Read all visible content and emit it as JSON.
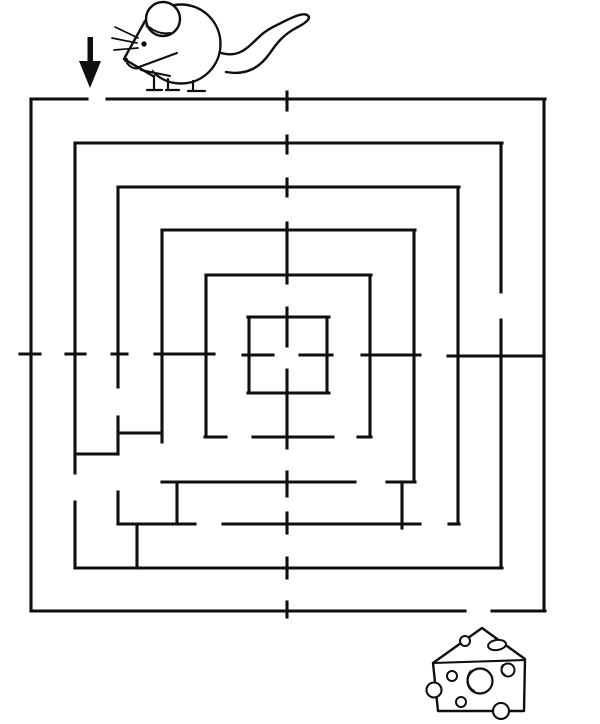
{
  "meta": {
    "kind": "printable-maze-puzzle",
    "description": "Square concentric maze; mouse with down-arrow marks the entrance at top, cheese wedge marks the goal at bottom right"
  },
  "colors": {
    "background": "#ffffff",
    "ink": "#0f0f0f"
  },
  "markers": {
    "start_icon": "mouse-icon",
    "start_pointer_icon": "down-arrow-icon",
    "goal_icon": "cheese-icon"
  },
  "maze": {
    "width": 600,
    "height": 724,
    "stroke_width": 3.1,
    "entrance_gap_x": [
      87,
      107
    ],
    "exit_gap_x": [
      465,
      492
    ],
    "h_walls": [
      [
        99,
        31,
        87
      ],
      [
        99,
        107,
        545
      ],
      [
        143,
        75,
        502
      ],
      [
        187,
        118,
        459
      ],
      [
        230,
        162,
        415
      ],
      [
        275,
        206,
        371
      ],
      [
        317,
        248,
        329
      ],
      [
        393,
        248,
        329
      ],
      [
        437,
        205,
        226
      ],
      [
        437,
        253,
        333
      ],
      [
        437,
        358,
        371
      ],
      [
        482,
        162,
        355
      ],
      [
        482,
        387,
        415
      ],
      [
        524,
        118,
        195
      ],
      [
        524,
        223,
        420
      ],
      [
        524,
        449,
        459
      ],
      [
        568,
        75,
        502
      ],
      [
        611,
        31,
        465
      ],
      [
        611,
        492,
        545
      ],
      [
        433,
        118,
        162
      ],
      [
        454,
        75,
        118
      ],
      [
        354,
        20,
        40
      ],
      [
        354,
        66,
        85
      ],
      [
        354,
        112,
        127
      ],
      [
        354,
        155,
        214
      ],
      [
        355,
        243,
        273
      ],
      [
        355,
        300,
        332
      ],
      [
        355,
        362,
        420
      ],
      [
        356,
        448,
        544
      ]
    ],
    "v_walls": [
      [
        31,
        99,
        611
      ],
      [
        544,
        99,
        611
      ],
      [
        75,
        143,
        473
      ],
      [
        75,
        502,
        568
      ],
      [
        501,
        143,
        292
      ],
      [
        501,
        320,
        568
      ],
      [
        118,
        187,
        387
      ],
      [
        118,
        417,
        454
      ],
      [
        118,
        492,
        524
      ],
      [
        458,
        187,
        524
      ],
      [
        162,
        230,
        442
      ],
      [
        414,
        230,
        482
      ],
      [
        206,
        275,
        437
      ],
      [
        370,
        275,
        437
      ],
      [
        249,
        317,
        393
      ],
      [
        327,
        317,
        393
      ],
      [
        287,
        92,
        110
      ],
      [
        287,
        136,
        153
      ],
      [
        287,
        179,
        196
      ],
      [
        287,
        223,
        283
      ],
      [
        287,
        308,
        346
      ],
      [
        287,
        370,
        448
      ],
      [
        287,
        472,
        496
      ],
      [
        287,
        513,
        533
      ],
      [
        287,
        558,
        578
      ],
      [
        287,
        602,
        617
      ],
      [
        137,
        524,
        568
      ],
      [
        177,
        482,
        524
      ],
      [
        402,
        482,
        528
      ]
    ]
  }
}
